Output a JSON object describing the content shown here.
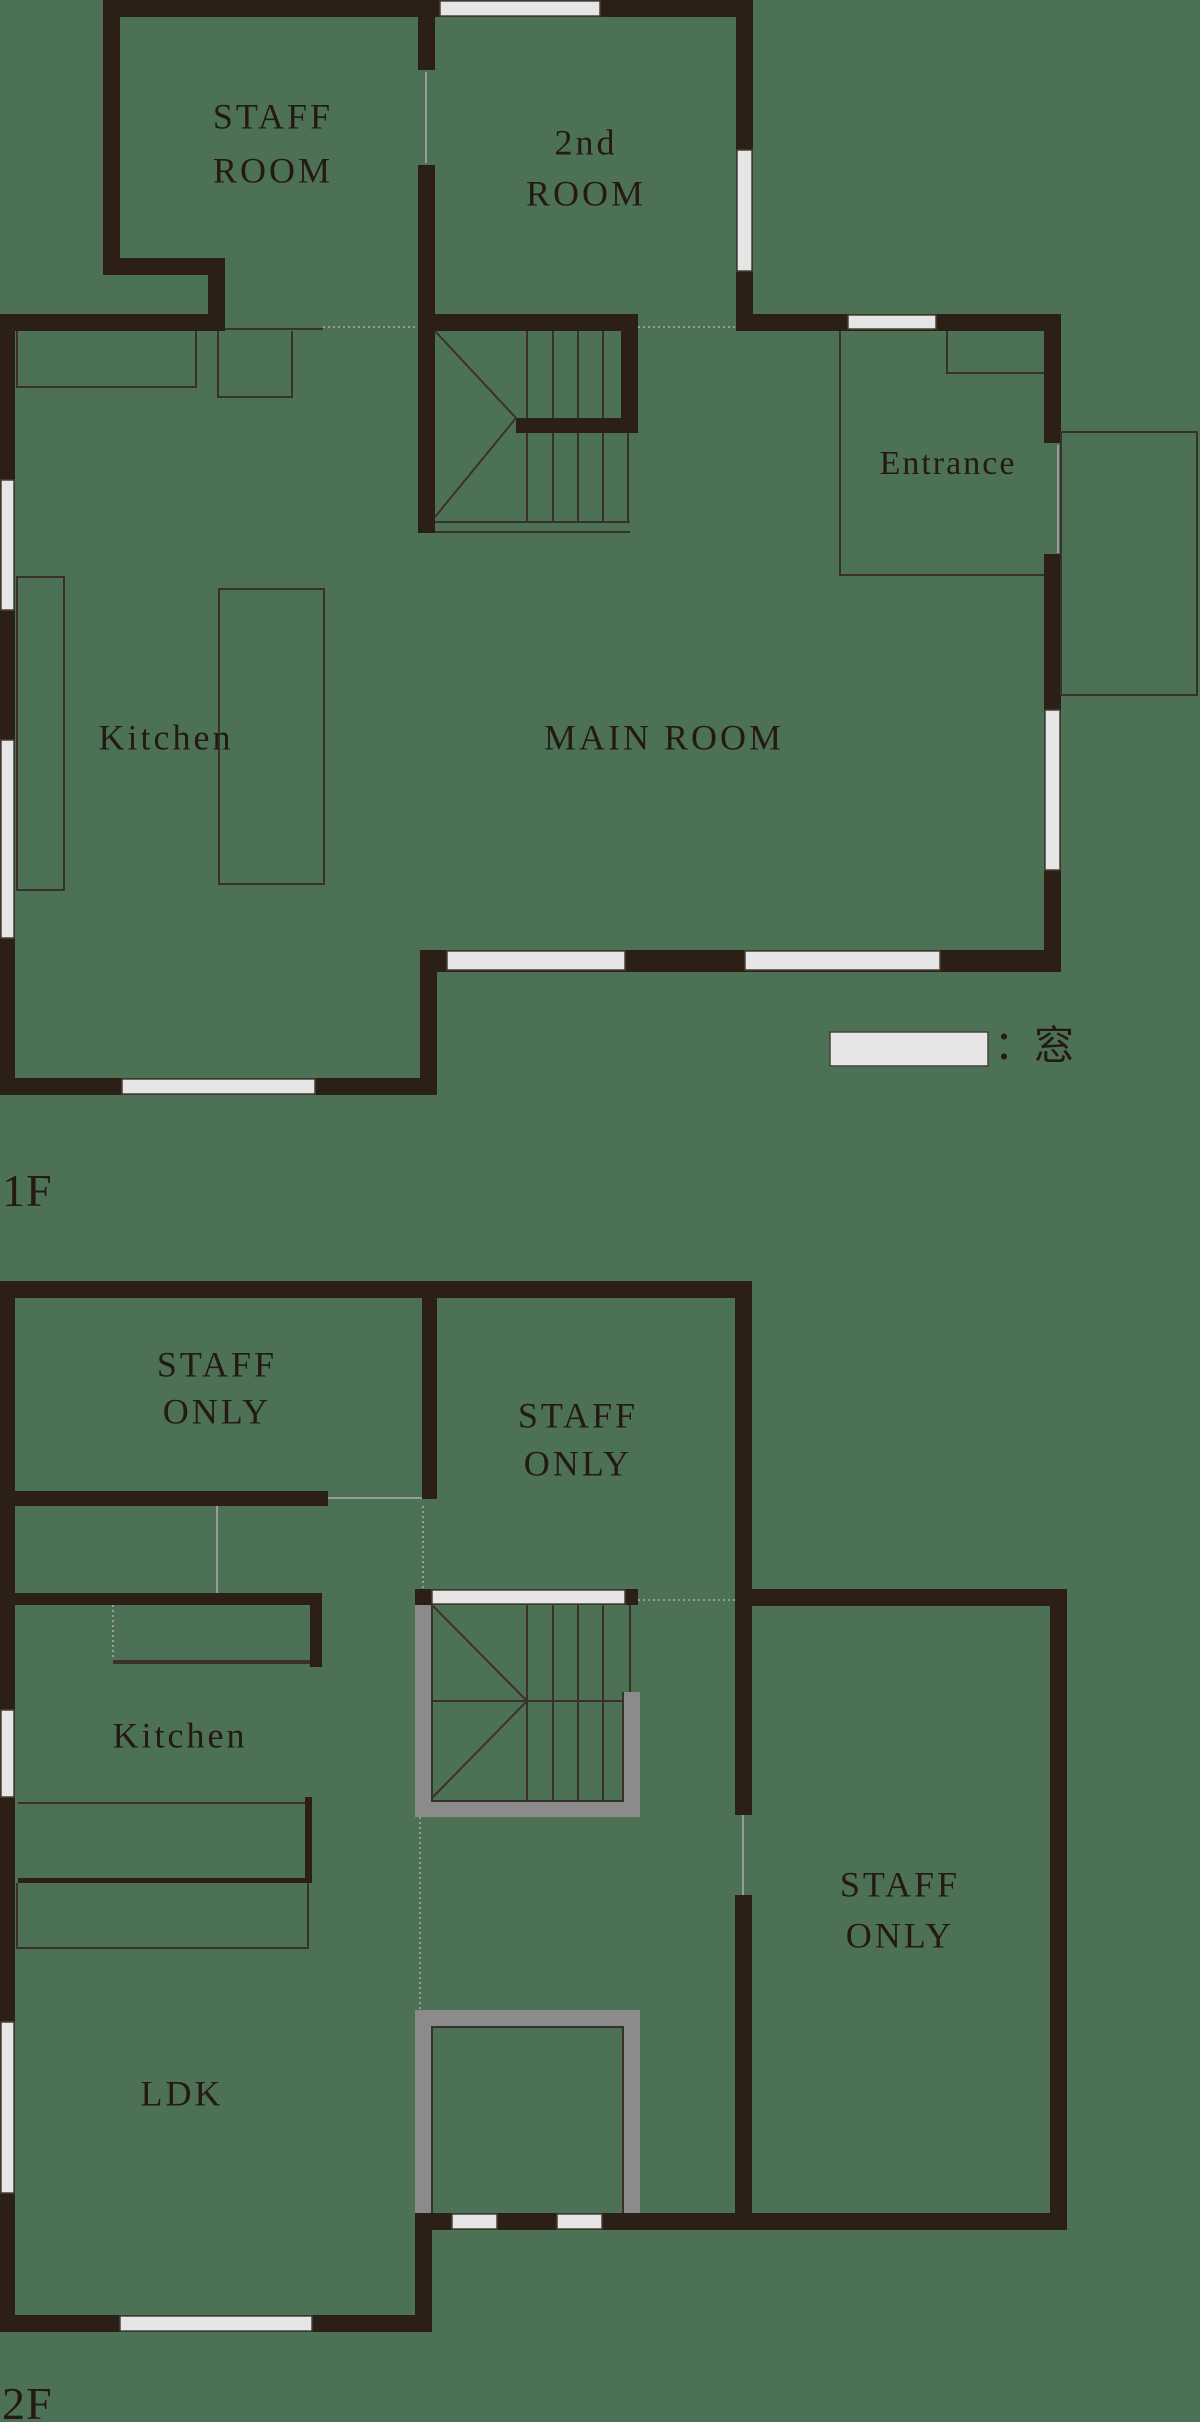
{
  "title": "Building floor plan 1F / 2F",
  "colors": {
    "background": "#4d7154",
    "wall": "#2c2016",
    "thin_line": "#3a322a",
    "gray_wall": "#8b8b8b",
    "light_line": "#9b9b9b",
    "window_fill": "#e6e6e6",
    "window_edge": "#474038",
    "text": "#241a12"
  },
  "floor_1f": {
    "name": "1F",
    "rooms": {
      "staff_room": [
        "STAFF",
        "ROOM"
      ],
      "second_room": [
        "2nd",
        "ROOM"
      ],
      "entrance": "Entrance",
      "kitchen": "Kitchen",
      "main_room": "MAIN ROOM"
    }
  },
  "floor_2f": {
    "name": "2F",
    "rooms": {
      "staff_only_top_left": [
        "STAFF",
        "ONLY"
      ],
      "staff_only_top_center": [
        "STAFF",
        "ONLY"
      ],
      "kitchen": "Kitchen",
      "ldk": "LDK",
      "staff_only_right": [
        "STAFF",
        "ONLY"
      ]
    }
  },
  "legend": {
    "window_label": "：窓"
  }
}
